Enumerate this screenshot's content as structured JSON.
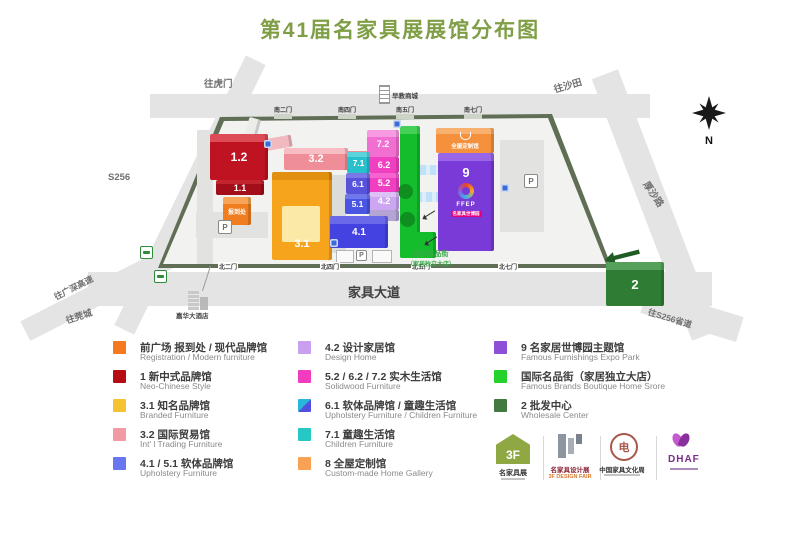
{
  "title": "第41届名家具展展馆分布图",
  "colors": {
    "title_green": "#7f9e45",
    "road_gray": "#e4e4e4",
    "fence_olive": "#5f6e55",
    "callout_green": "#3aa84a"
  },
  "map": {
    "compass": "N",
    "parking_label": "P",
    "labels": [
      {
        "text": "往虎门",
        "x": 204,
        "y": 76,
        "s": 9.5,
        "rot": 0
      },
      {
        "text": "往沙田",
        "x": 552,
        "y": 82,
        "s": 9.5,
        "rot": -16
      },
      {
        "text": "S256",
        "x": 108,
        "y": 172,
        "s": 9.5,
        "rot": 0
      },
      {
        "text": "厚沙路",
        "x": 652,
        "y": 178,
        "s": 9.5,
        "rot": 56
      },
      {
        "text": "往S256省道",
        "x": 650,
        "y": 306,
        "s": 8.5,
        "rot": 17
      },
      {
        "text": "往广深高速",
        "x": 52,
        "y": 292,
        "s": 8.5,
        "rot": -27
      },
      {
        "text": "往莞城",
        "x": 64,
        "y": 314,
        "s": 9,
        "rot": -18
      },
      {
        "text": "家具大道",
        "x": 348,
        "y": 282,
        "s": 13,
        "rot": 0,
        "bold": true,
        "color": "#3f3f3f"
      },
      {
        "text": "嘉华大酒店",
        "x": 176,
        "y": 310,
        "s": 6.5,
        "rot": 0,
        "color": "#444444"
      },
      {
        "text": "早教商城",
        "x": 392,
        "y": 90,
        "s": 6.5,
        "rot": 0,
        "color": "#444444"
      }
    ],
    "gates_top": [
      "南二门",
      "南四门",
      "南五门",
      "南七门"
    ],
    "gates_bottom": [
      "北二门",
      "北四门",
      "北五门",
      "北七门"
    ],
    "callout": {
      "line1": "国际名品街",
      "line2": "（家居独立大店）"
    },
    "buildings": [
      {
        "id": "walkway-ramp",
        "label": "",
        "x": 246,
        "y": 118,
        "w": 12,
        "h": 26,
        "c": "#ececea",
        "rot": 15
      },
      {
        "id": "hall-3-2-ramp",
        "label": "",
        "x": 252,
        "y": 138,
        "w": 40,
        "h": 12,
        "c": "#f3b9c0",
        "rot": -10
      },
      {
        "id": "hall-3-2-arm",
        "label": "",
        "x": 344,
        "y": 151,
        "w": 28,
        "h": 10,
        "c": "#ef8e99"
      },
      {
        "id": "hall-3-2",
        "label": "3.2",
        "x": 284,
        "y": 148,
        "w": 64,
        "h": 22,
        "c": "#ef8e99",
        "t": "#f7bdc3",
        "fs": 11
      },
      {
        "id": "hall-1-2",
        "label": "1.2",
        "x": 210,
        "y": 134,
        "w": 58,
        "h": 46,
        "c": "#bf1322",
        "t": "#dd4b57",
        "fs": 12
      },
      {
        "id": "hall-1-1",
        "label": "1.1",
        "x": 216,
        "y": 180,
        "w": 48,
        "h": 15,
        "c": "#a30e1a",
        "t": "#c22430",
        "fs": 9
      },
      {
        "id": "registration-office",
        "label": "报到处",
        "x": 223,
        "y": 197,
        "w": 28,
        "h": 28,
        "c": "#f07d1f",
        "t": "#f7a558",
        "fs": 6
      },
      {
        "id": "hall-3-1",
        "label": "3.1",
        "x": 272,
        "y": 172,
        "w": 60,
        "h": 88,
        "c": "#f6a41c",
        "t": "#e18f0e",
        "fs": 11,
        "lp": "b",
        "roof": "#fbe9a8"
      },
      {
        "id": "famous-brands-street",
        "label": "",
        "x": 400,
        "y": 126,
        "w": 20,
        "h": 132,
        "c": "#13bd2b",
        "t": "#45d158"
      },
      {
        "id": "famous-brands-street-south",
        "label": "",
        "x": 400,
        "y": 232,
        "w": 36,
        "h": 26,
        "c": "#13bd2b"
      },
      {
        "id": "green-bump-1",
        "label": "",
        "x": 398,
        "y": 184,
        "w": 15,
        "h": 15,
        "c": "#0e8f20",
        "shape": "circle"
      },
      {
        "id": "green-bump-2",
        "label": "",
        "x": 400,
        "y": 212,
        "w": 15,
        "h": 15,
        "c": "#0e8f20",
        "shape": "circle"
      },
      {
        "id": "hall-7-2",
        "label": "7.2",
        "x": 367,
        "y": 130,
        "w": 32,
        "h": 27,
        "c": "#f26fd2",
        "t": "#f79ae2",
        "fs": 9
      },
      {
        "id": "hall-6-2",
        "label": "6.2",
        "x": 369,
        "y": 157,
        "w": 30,
        "h": 16,
        "c": "#f13fc1",
        "fs": 9
      },
      {
        "id": "hall-5-2",
        "label": "5.2",
        "x": 369,
        "y": 173,
        "w": 30,
        "h": 19,
        "c": "#f13fc1",
        "t": "#f564cf",
        "fs": 9
      },
      {
        "id": "hall-4-2",
        "label": "4.2",
        "x": 369,
        "y": 192,
        "w": 30,
        "h": 18,
        "c": "#cda6f1",
        "t": "#ddc0f6",
        "fs": 9
      },
      {
        "id": "hall-4-2-base",
        "label": "",
        "x": 369,
        "y": 210,
        "w": 30,
        "h": 11,
        "c": "#b3a4d4"
      },
      {
        "id": "hall-7-1",
        "label": "7.1",
        "x": 347,
        "y": 152,
        "w": 23,
        "h": 21,
        "c": "#27c0cb",
        "t": "#5cd3db",
        "fs": 8.5
      },
      {
        "id": "hall-6-1",
        "label": "6.1",
        "x": 346,
        "y": 173,
        "w": 24,
        "h": 21,
        "c": "#5753da",
        "t": "#7b77e6",
        "fs": 8.5
      },
      {
        "id": "hall-5-1",
        "label": "5.1",
        "x": 345,
        "y": 194,
        "w": 25,
        "h": 20,
        "c": "#4a55e4",
        "t": "#6f79ec",
        "fs": 8.5
      },
      {
        "id": "hall-4-1",
        "label": "4.1",
        "x": 330,
        "y": 216,
        "w": 58,
        "h": 32,
        "c": "#4443e2",
        "t": "#6a69ea",
        "fs": 10
      },
      {
        "id": "hall-8",
        "label": "全屋定制馆",
        "x": 436,
        "y": 128,
        "w": 58,
        "h": 25,
        "c": "#f5913c",
        "t": "#f8b06e",
        "fs": 5.5,
        "icon": true
      },
      {
        "id": "hall-9",
        "label": "9",
        "x": 438,
        "y": 153,
        "w": 56,
        "h": 98,
        "c": "#7a3ad7",
        "t": "#9a66e8",
        "fs": 13,
        "logo": "FFEP",
        "sub": "名家具世博园"
      },
      {
        "id": "hall-2-arrow",
        "label": "",
        "x": 604,
        "y": 250,
        "w": 36,
        "h": 12,
        "c": "#1e5c24",
        "rot": -14,
        "shape": "arrow"
      },
      {
        "id": "hall-2",
        "label": "2",
        "x": 606,
        "y": 262,
        "w": 58,
        "h": 44,
        "c": "#2f7d35",
        "t": "#55a15b",
        "fs": 13
      }
    ]
  },
  "legend": {
    "columns": [
      {
        "items": [
          {
            "zh": "前广场 报到处 / 现代品牌馆",
            "en": "Registration / Modern furniture",
            "c": "#f57a1f"
          },
          {
            "zh": "1 新中式品牌馆",
            "en": "Neo-Chinese Style",
            "c": "#b60d15"
          },
          {
            "zh": "3.1 知名品牌馆",
            "en": "Branded Furniture",
            "c": "#f5c332"
          },
          {
            "zh": "3.2 国际贸易馆",
            "en": "Int' l Trading Furniture",
            "c": "#f29aa2"
          },
          {
            "zh": "4.1 / 5.1 软体品牌馆",
            "en": "Upholstery Furniture",
            "c": "#6a75f2"
          }
        ]
      },
      {
        "items": [
          {
            "zh": "4.2 设计家居馆",
            "en": "Design Home",
            "c": "#c9a0ef"
          },
          {
            "zh": "5.2 / 6.2 / 7.2 实木生活馆",
            "en": "Solidwood Furniture",
            "c": "#f23cc0"
          },
          {
            "zh": "6.1 软体品牌馆 / 童趣生活馆",
            "en": "Upholstery Furniture / Children Furniture",
            "c": "#2ab6d9",
            "c2": "#5150e0"
          },
          {
            "zh": "7.1 童趣生活馆",
            "en": "Children Furniture",
            "c": "#25c8c4"
          },
          {
            "zh": "8 全屋定制馆",
            "en": "Custom-made Home Gallery",
            "c": "#f9a254"
          }
        ]
      },
      {
        "items": [
          {
            "zh": "9 名家居世博园主题馆",
            "en": "Famous Furnishings Expo Park",
            "c": "#8c4fd6"
          },
          {
            "zh": "国际名品街（家居独立大店）",
            "en": "Famous Brands Boutique Home Srore",
            "c": "#25d22b"
          },
          {
            "zh": "2 批发中心",
            "en": "Wholesale Center",
            "c": "#41793f"
          }
        ]
      }
    ]
  },
  "logos": {
    "fair": {
      "mark": "3F",
      "caption": "名家具展"
    },
    "design": {
      "caption_zh": "名家具设计展",
      "caption_en": "3F DESIGN FAIR"
    },
    "culture": {
      "glyph": "电",
      "caption": "中国家具文化周"
    },
    "dhaf": {
      "caption": "DHAF"
    }
  }
}
